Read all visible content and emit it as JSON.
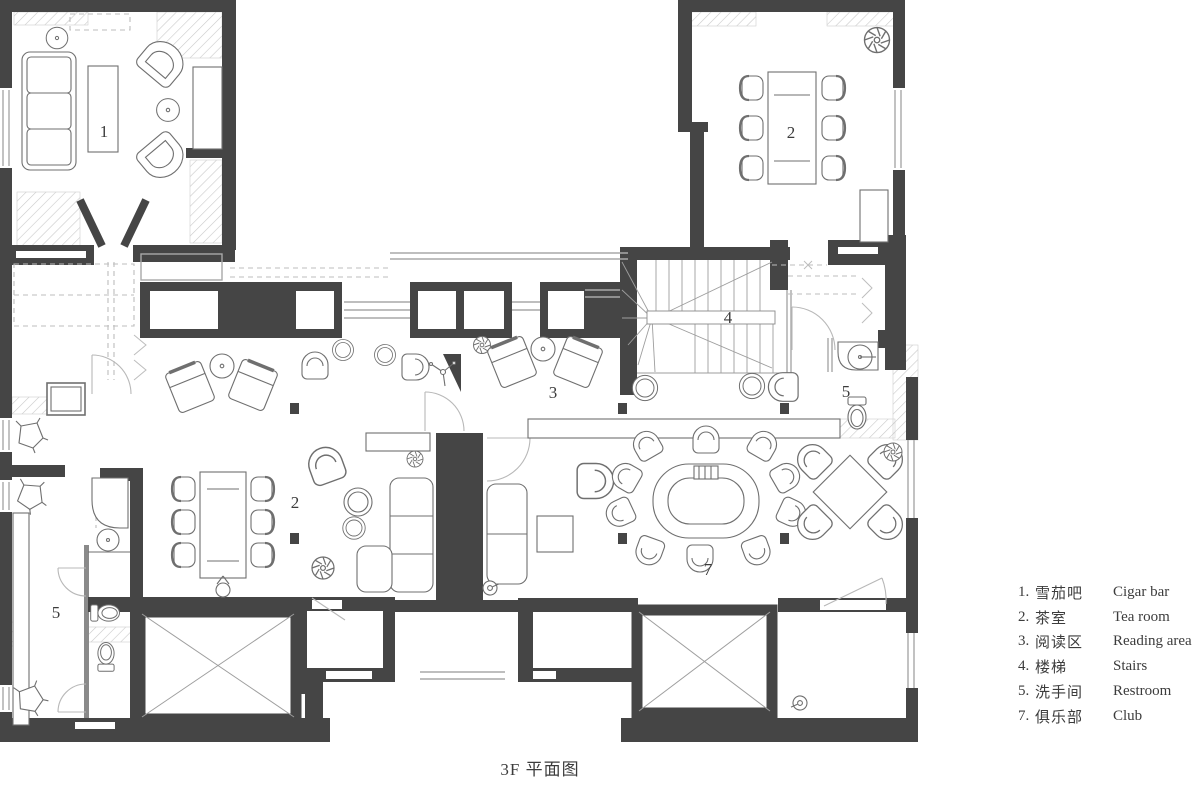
{
  "doc": {
    "title": "3F 平面图"
  },
  "legend": {
    "items": [
      {
        "num": "1.",
        "zh": "雪茄吧",
        "en": "Cigar bar"
      },
      {
        "num": "2.",
        "zh": "茶室",
        "en": "Tea room"
      },
      {
        "num": "3.",
        "zh": "阅读区",
        "en": "Reading area"
      },
      {
        "num": "4.",
        "zh": "楼梯",
        "en": "Stairs"
      },
      {
        "num": "5.",
        "zh": "洗手间",
        "en": "Restroom"
      },
      {
        "num": "7.",
        "zh": "俱乐部",
        "en": "Club"
      }
    ]
  },
  "room_labels": {
    "cigar_bar": "1",
    "tea_room_top": "2",
    "tea_room_left": "2",
    "reading_area": "3",
    "stairs": "4",
    "restroom_right": "5",
    "restroom_left": "5",
    "club": "7"
  },
  "colors": {
    "wall": "#454545",
    "furniture_line": "#6f6f6f",
    "light_line": "#a9a9a9",
    "dash_line": "#bdbdbd",
    "text": "#3c3c3c",
    "background": "#ffffff"
  }
}
